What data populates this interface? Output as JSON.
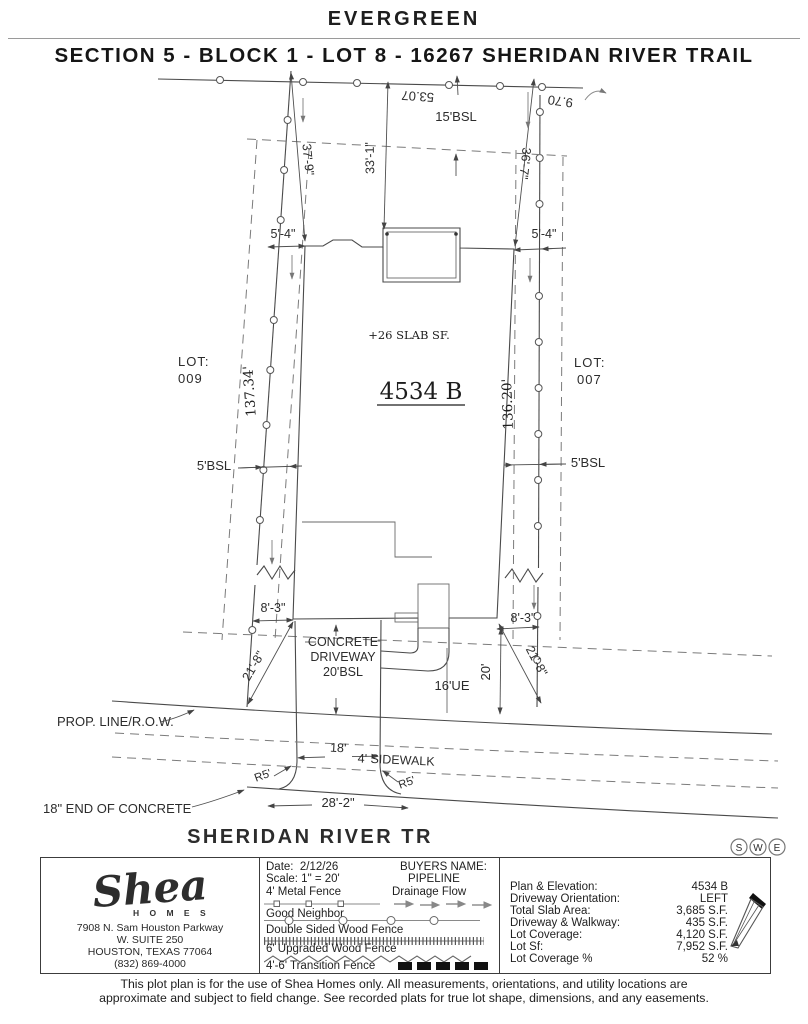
{
  "header": {
    "subdivision": "EVERGREEN",
    "title": "SECTION 5 - BLOCK 1 - LOT 8 - 16267 SHERIDAN RIVER TRAIL"
  },
  "drawing": {
    "rear_dim_a": "53.07",
    "rear_dim_b": "9.70",
    "rear_bsl": "15'BSL",
    "dim_left": "37'-9\"",
    "dim_center": "33'-1\"",
    "dim_right": "36'-7\"",
    "offset_rear_left": "5'-4\"",
    "offset_rear_right": "5'-4\"",
    "slab_note": "+26 SLAB SF.",
    "plan_number": "4534 B",
    "lot_left_label": "LOT:",
    "lot_left_value": "009",
    "lot_right_label": "LOT:",
    "lot_right_value": "007",
    "len_left": "137.34'",
    "len_right": "136.20'",
    "bsl_left": "5'BSL",
    "bsl_right": "5'BSL",
    "offset_front_left": "8'-3\"",
    "offset_front_right": "8'-3\"",
    "driveway_line1": "CONCRETE",
    "driveway_line2": "DRIVEWAY",
    "driveway_line3": "20'BSL",
    "ue_label": "16'UE",
    "front_depth": "20'",
    "diag_left": "21'-8\"",
    "diag_right": "21'-8\"",
    "prop_line": "PROP. LINE/R.O.W.",
    "drive_width": "18'",
    "sidewalk": "4' SIDEWALK",
    "radius_left": "R5'",
    "radius_right": "R5'",
    "apron_width": "28'-2\"",
    "end_concrete": "18\" END OF CONCRETE",
    "street": "SHERIDAN RIVER TR",
    "stamp": {
      "s": "S",
      "w": "W",
      "e": "E"
    }
  },
  "footer": {
    "logo": {
      "script": "Shea",
      "homes": "H O M E S",
      "address1": "7908 N. Sam Houston Parkway",
      "address2": "W. SUITE 250",
      "address3": "HOUSTON, TEXAS 77064",
      "phone": "(832) 869-4000"
    },
    "legend": {
      "date_label": "Date:",
      "date_value": "2/12/26",
      "scale_label": "Scale:",
      "scale_value": "1\" = 20'",
      "buyers_label": "BUYERS NAME:",
      "buyers_value": "PIPELINE",
      "metal_fence": "4' Metal Fence",
      "drainage_flow": "Drainage Flow",
      "good_neighbor": "Good Neighbor",
      "double_sided": "Double Sided Wood Fence",
      "upgraded": "6' Upgraded Wood Fence",
      "transition": "4'-6' Transition Fence"
    },
    "stats": {
      "rows": [
        {
          "label": "Plan & Elevation:",
          "value": "4534 B"
        },
        {
          "label": "Driveway Orientation:",
          "value": "LEFT"
        },
        {
          "label": "Total Slab Area:",
          "value": "3,685 S.F."
        },
        {
          "label": "Driveway & Walkway:",
          "value": "435 S.F."
        },
        {
          "label": "Lot Coverage:",
          "value": "4,120 S.F."
        },
        {
          "label": "Lot Sf:",
          "value": "7,952 S.F."
        },
        {
          "label": "Lot Coverage %",
          "value": "52 %"
        }
      ]
    },
    "disclaimer1": "This plot plan is for the use of Shea Homes only. All measurements, orientations, and utility locations are",
    "disclaimer2": "approximate and subject to field change. See recorded plats for true lot shape, dimensions, and any easements."
  }
}
